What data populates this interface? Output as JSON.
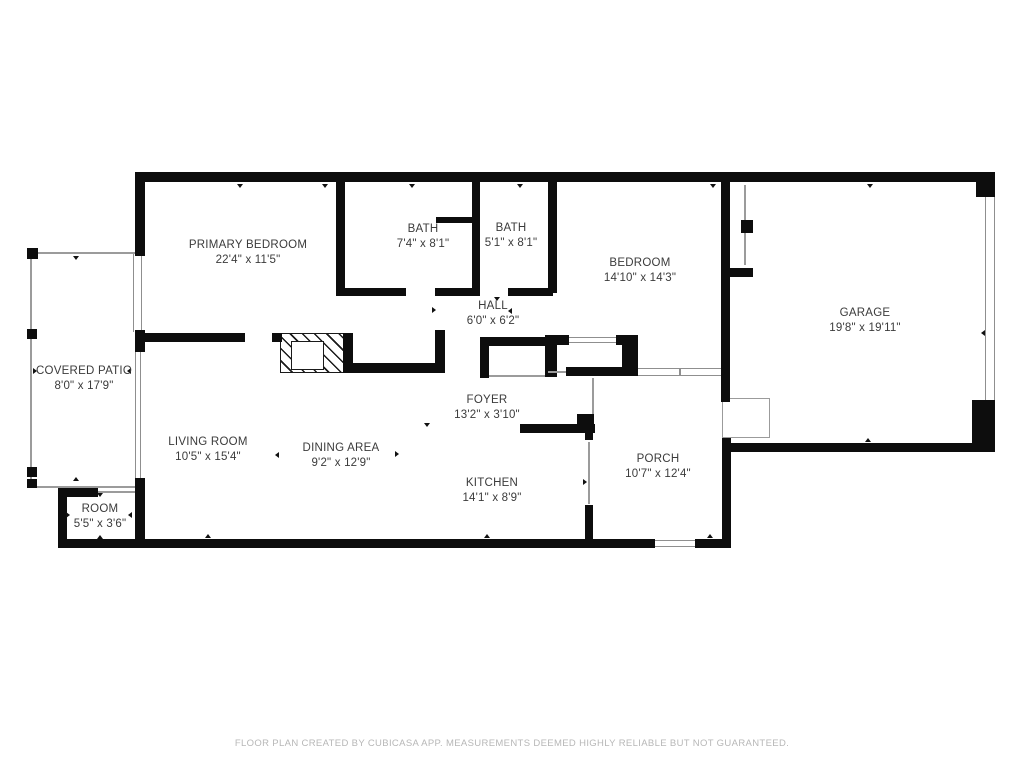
{
  "colors": {
    "wall": "#0d0d0d",
    "thin_line": "#9b9b9b",
    "label_text": "#3b3b3b",
    "footer_text": "#b7b7b7",
    "background": "#ffffff"
  },
  "rooms": [
    {
      "id": "primary-bedroom",
      "name": "PRIMARY BEDROOM",
      "dims": "22'4\" x 11'5\""
    },
    {
      "id": "bath-1",
      "name": "BATH",
      "dims": "7'4\" x 8'1\""
    },
    {
      "id": "bath-2",
      "name": "BATH",
      "dims": "5'1\" x 8'1\""
    },
    {
      "id": "bedroom",
      "name": "BEDROOM",
      "dims": "14'10\" x 14'3\""
    },
    {
      "id": "garage",
      "name": "GARAGE",
      "dims": "19'8\" x 19'11\""
    },
    {
      "id": "covered-patio",
      "name": "COVERED PATIO",
      "dims": "8'0\" x 17'9\""
    },
    {
      "id": "hall",
      "name": "HALL",
      "dims": "6'0\" x 6'2\""
    },
    {
      "id": "foyer",
      "name": "FOYER",
      "dims": "13'2\" x 3'10\""
    },
    {
      "id": "living-room",
      "name": "LIVING ROOM",
      "dims": "10'5\" x 15'4\""
    },
    {
      "id": "dining-area",
      "name": "DINING AREA",
      "dims": "9'2\" x 12'9\""
    },
    {
      "id": "kitchen",
      "name": "KITCHEN",
      "dims": "14'1\" x 8'9\""
    },
    {
      "id": "porch",
      "name": "PORCH",
      "dims": "10'7\" x 12'4\""
    },
    {
      "id": "room",
      "name": "ROOM",
      "dims": "5'5\" x 3'6\""
    }
  ],
  "footer": {
    "text": "FLOOR PLAN CREATED BY CUBICASA APP. MEASUREMENTS DEEMED HIGHLY RELIABLE BUT NOT GUARANTEED."
  }
}
